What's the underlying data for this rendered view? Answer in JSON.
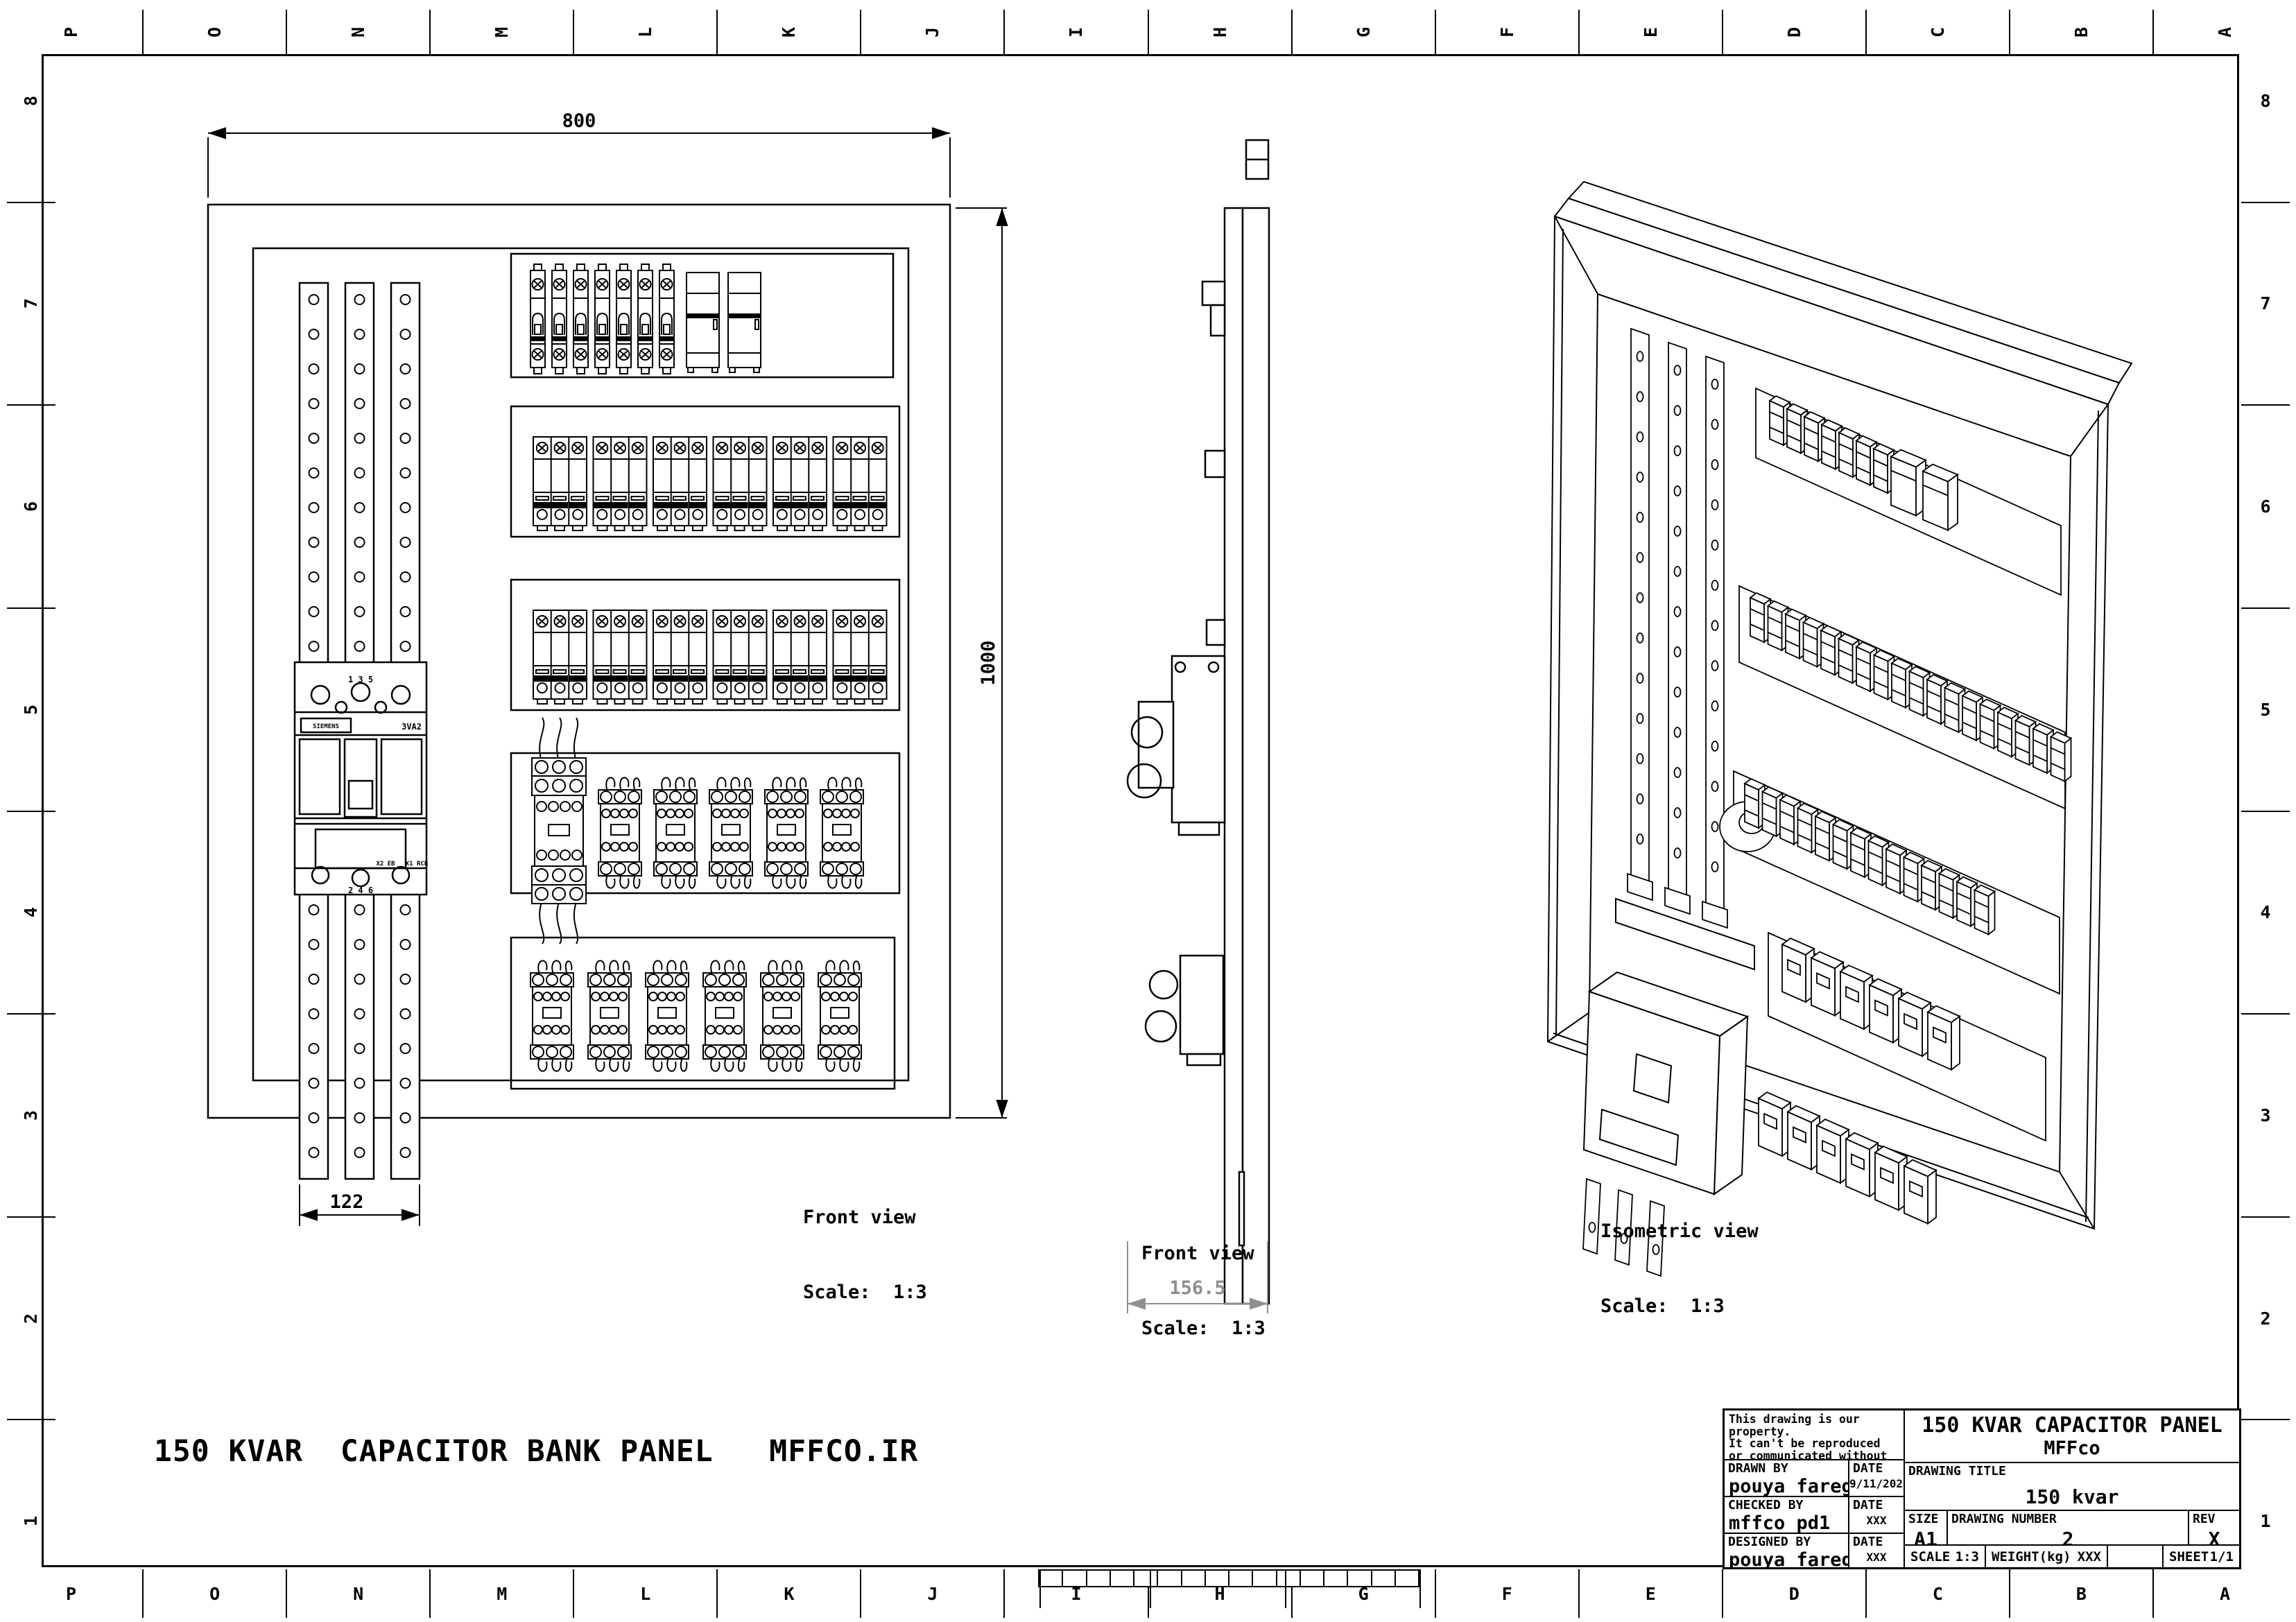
{
  "sheet": {
    "grid_columns": [
      "P",
      "O",
      "N",
      "M",
      "L",
      "K",
      "J",
      "I",
      "H",
      "G",
      "F",
      "E",
      "D",
      "C",
      "B",
      "A"
    ],
    "grid_rows": [
      "8",
      "7",
      "6",
      "5",
      "4",
      "3",
      "2",
      "1"
    ],
    "main_title": "150 KVAR  CAPACITOR BANK PANEL   MFFCO.IR"
  },
  "views": {
    "front_panel": {
      "label": "Front view",
      "scale_label": "Scale:  1:3",
      "dim_width": "800",
      "dim_height": "1000",
      "dim_busbar": "122",
      "main_breaker": {
        "brand": "SIEMENS",
        "model": "3VA2",
        "top_terminals": "1   3   5",
        "bottom_terminals": "2   4   6",
        "aux_label_1": "X2 EB",
        "aux_label_2": "X1 RCB"
      },
      "rows": [
        {
          "name": "top-breaker-row",
          "units": [
            {
              "type": "mcb1",
              "count": 7
            },
            {
              "type": "aux",
              "count": 2
            }
          ]
        },
        {
          "name": "breaker-row-2",
          "units": [
            {
              "type": "mcb3",
              "count": 6
            }
          ]
        },
        {
          "name": "breaker-row-3",
          "units": [
            {
              "type": "mcb3",
              "count": 6
            }
          ]
        },
        {
          "name": "contactor-row-1",
          "units": [
            {
              "type": "cap_contactor",
              "count": 1
            },
            {
              "type": "contactor",
              "count": 5
            }
          ]
        },
        {
          "name": "contactor-row-2",
          "units": [
            {
              "type": "contactor",
              "count": 6
            }
          ]
        }
      ]
    },
    "side_panel": {
      "label": "Front view",
      "scale_label": "Scale:  1:3",
      "dim_depth": "156.5"
    },
    "isometric": {
      "label": "Isometric view",
      "scale_label": "Scale:  1:3",
      "rows": [
        {
          "counts": [
            7,
            2
          ]
        },
        {
          "counts": [
            18
          ]
        },
        {
          "counts": [
            14
          ]
        },
        {
          "counts": [
            6
          ]
        },
        {
          "counts": [
            6
          ]
        }
      ]
    }
  },
  "title_block": {
    "property_notice": [
      "This drawing is our property.",
      "It can't be reproduced",
      "or communicated without",
      "our written agreement."
    ],
    "drawn_by_label": "DRAWN BY",
    "drawn_by": "pouya faregh",
    "drawn_date_label": "DATE",
    "drawn_date": "9/11/2025",
    "checked_by_label": "CHECKED BY",
    "checked_by": "mffco pd1",
    "checked_date_label": "DATE",
    "checked_date": "XXX",
    "designed_by_label": "DESIGNED BY",
    "designed_by": "pouya faregh",
    "designed_date_label": "DATE",
    "designed_date": "XXX",
    "company_title_line1": "150 KVAR CAPACITOR PANEL",
    "company_title_line2": "MFFco",
    "drawing_title_label": "DRAWING TITLE",
    "drawing_title": "150 kvar",
    "size_label": "SIZE",
    "size_value": "A1",
    "drawing_number_label": "DRAWING NUMBER",
    "drawing_number": "2",
    "rev_label": "REV",
    "rev_value": "X",
    "scale_label": "SCALE",
    "scale_value": "1:3",
    "weight_label": "WEIGHT(kg)",
    "weight_value": "XXX",
    "sheet_label": "SHEET",
    "sheet_value": "1/1"
  },
  "colors": {
    "line": "#000000",
    "dim_secondary": "#8f8f8f",
    "background": "#ffffff"
  }
}
